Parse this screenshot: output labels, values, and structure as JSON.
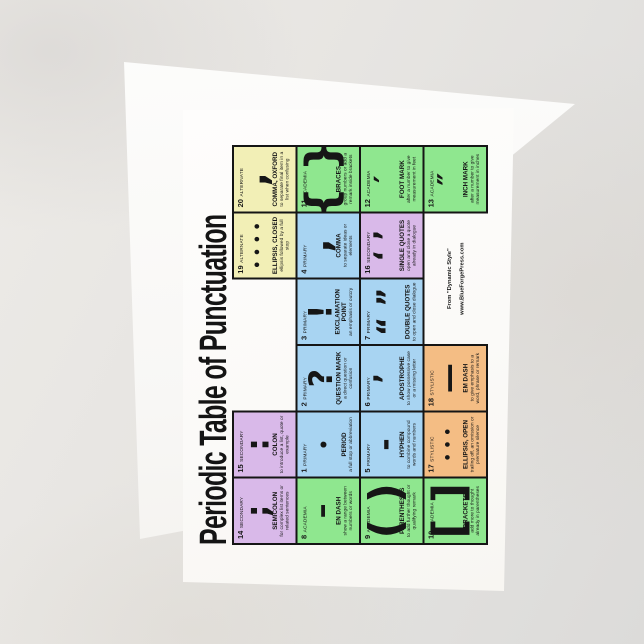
{
  "colors": {
    "primary": "#a8d4f2",
    "secondary": "#d9b9e9",
    "academia": "#8fe78f",
    "stylistic": "#f4bd84",
    "alternate": "#f2efb6",
    "card-white": "#fcfbf9",
    "table-border": "#151515",
    "background": "#e5e3e0"
  },
  "title": "Periodic Table of Punctuation",
  "credit": {
    "line1": "From \"Dynamic Style\"",
    "line2": "www.BlueForgePress.com"
  },
  "cells": [
    {
      "number": "1",
      "category": "PRIMARY",
      "symbol": "•",
      "name": "PERIOD",
      "desc": "a full stop or abbreviation"
    },
    {
      "number": "2",
      "category": "PRIMARY",
      "symbol": "?",
      "name": "QUESTION MARK",
      "desc": "a direct question or confusion"
    },
    {
      "number": "3",
      "category": "PRIMARY",
      "symbol": "!",
      "name": "EXCLAMATION POINT",
      "desc": "an emphasis or outcry"
    },
    {
      "number": "4",
      "category": "PRIMARY",
      "symbol": ",",
      "name": "COMMA",
      "desc": "to separate ideas or elements"
    },
    {
      "number": "5",
      "category": "PRIMARY",
      "symbol": "-",
      "name": "HYPHEN",
      "desc": "to combine compound words and numbers"
    },
    {
      "number": "6",
      "category": "PRIMARY",
      "symbol": "’",
      "name": "APOSTROPHE",
      "desc": "to show possessive case or a missing letter"
    },
    {
      "number": "7",
      "category": "PRIMARY",
      "symbol": "“ ”",
      "name": "DOUBLE QUOTES",
      "desc": "to open and close dialogue"
    },
    {
      "number": "8",
      "category": "ACADEMIA",
      "symbol": "–",
      "name": "EN DASH",
      "desc": "show a range between numbers or words"
    },
    {
      "number": "9",
      "category": "ACADEMIA",
      "symbol": "( )",
      "name": "PARENTHESES",
      "desc": "to add further thought or qualifying remark"
    },
    {
      "number": "10",
      "category": "ACADEMIA",
      "symbol": "[ ]",
      "name": "BRACKETS",
      "desc": "add more to thought already in parentheses"
    },
    {
      "number": "11",
      "category": "ACADEMIA",
      "symbol": "{ }",
      "name": "BRACES",
      "desc": "group numbers or add a remark inside brackets"
    },
    {
      "number": "12",
      "category": "ACADEMIA",
      "symbol": "′",
      "name": "FOOT MARK",
      "desc": "after a number to give measurement in feet"
    },
    {
      "number": "13",
      "category": "ACADEMIA",
      "symbol": "″",
      "name": "INCH MARK",
      "desc": "after a number to give measurement in inches"
    },
    {
      "number": "14",
      "category": "SECONDARY",
      "symbol": ";",
      "name": "SEMICOLON",
      "desc": "for complex list items or related sentences"
    },
    {
      "number": "15",
      "category": "SECONDARY",
      "symbol": ":",
      "name": "COLON",
      "desc": "to introduce a list, quote or example"
    },
    {
      "number": "16",
      "category": "SECONDARY",
      "symbol": "‘ ’",
      "name": "SINGLE QUOTES",
      "desc": "open and close a quote already in dialogue"
    },
    {
      "number": "17",
      "category": "STYLISTIC",
      "symbol": "•••",
      "name": "ELLIPSIS, OPEN",
      "desc": "trailing off, an omission or premature silence"
    },
    {
      "number": "18",
      "category": "STYLISTIC",
      "symbol": "—",
      "name": "EM DASH",
      "desc": "to give emphasis to a word, phrase or remark"
    },
    {
      "number": "19",
      "category": "ALTERNATE",
      "symbol": "••••",
      "name": "ELLIPSIS, CLOSED",
      "desc": "ellipsis followed by a full stop"
    },
    {
      "number": "20",
      "category": "ALTERNATE",
      "symbol": ",",
      "name": "COMMA, OXFORD",
      "desc": "to separate final item in a list when confusing"
    }
  ],
  "grid_rows": [
    [
      "14",
      "15",
      "",
      "",
      "19",
      "20"
    ],
    [
      "8",
      "1",
      "2",
      "3",
      "4",
      "11"
    ],
    [
      "9",
      "5",
      "6",
      "7",
      "16",
      "12"
    ],
    [
      "10",
      "17",
      "18",
      "credit",
      "credit",
      "13"
    ]
  ]
}
